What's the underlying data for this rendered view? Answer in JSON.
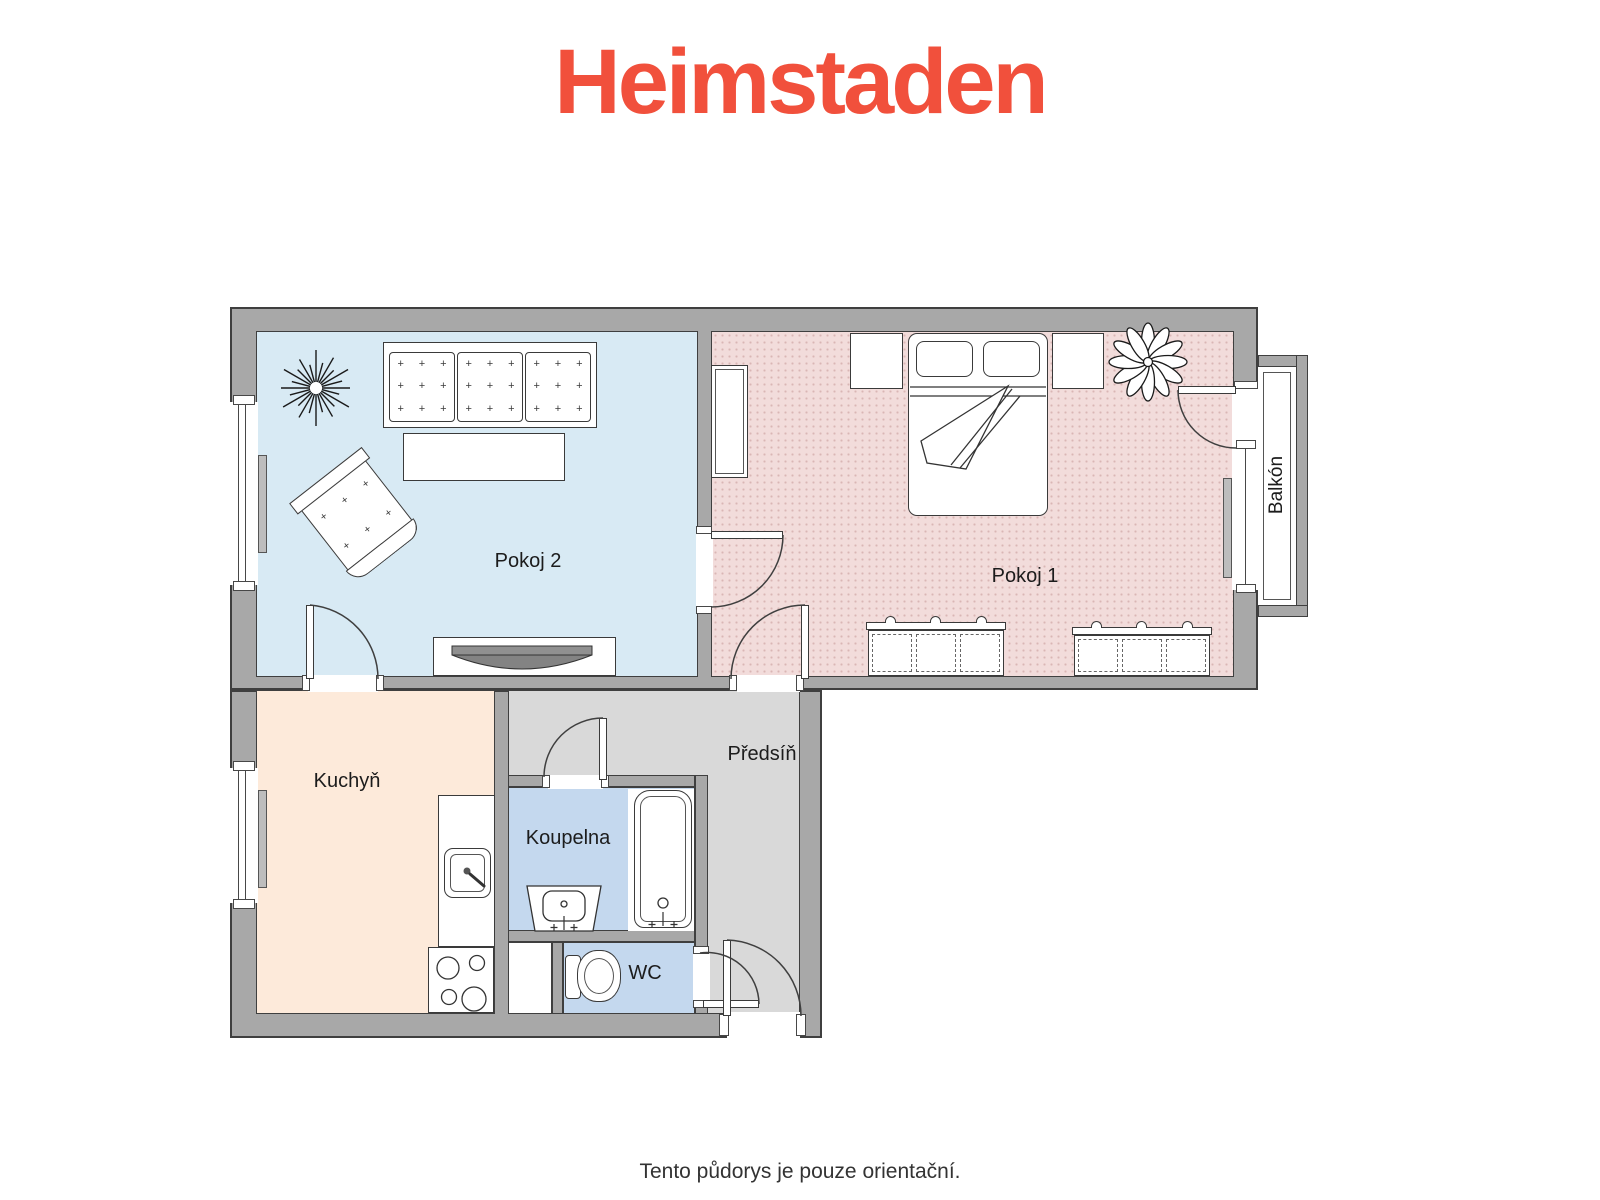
{
  "brand": {
    "logo_text": "Heimstaden",
    "logo_color": "#F1503C"
  },
  "plan": {
    "wall_fill": "#a8a8a8",
    "wall_outline": "#3f3f3f",
    "rooms": [
      {
        "id": "pokoj2",
        "label": "Pokoj 2",
        "color": "#d8eaf4"
      },
      {
        "id": "pokoj1",
        "label": "Pokoj 1",
        "color": "#f2dcdb"
      },
      {
        "id": "kuchyn",
        "label": "Kuchyň",
        "color": "#fdeada"
      },
      {
        "id": "koupelna",
        "label": "Koupelna",
        "color": "#c4d8ee"
      },
      {
        "id": "wc",
        "label": "WC",
        "color": "#c4d8ee"
      },
      {
        "id": "predsin",
        "label": "Předsíň",
        "color": "#d9d9d9"
      },
      {
        "id": "balkon",
        "label": "Balkón",
        "color": "#ffffff"
      }
    ]
  },
  "footer": {
    "disclaimer": "Tento půdorys je pouze orientační."
  }
}
